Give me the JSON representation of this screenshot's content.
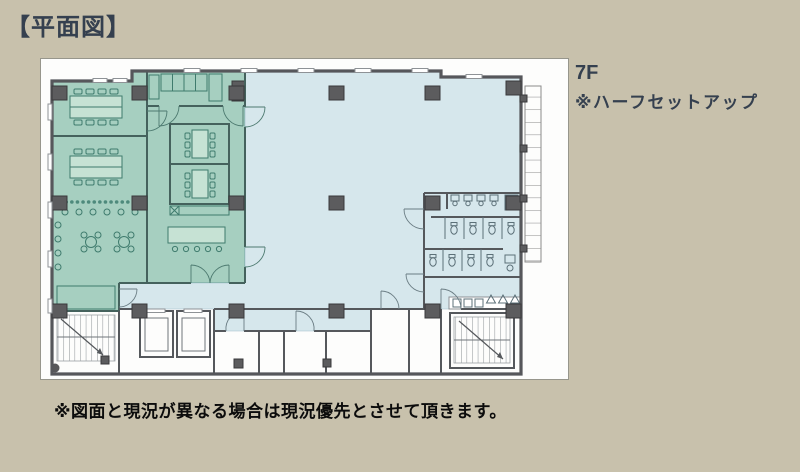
{
  "title": "【平面図】",
  "plan_labels": {
    "floor": "7F",
    "setup_note": "※ハーフセットアップ"
  },
  "footer_note": "※図面と現況が異なる場合は現況優先とさせて頂きます。",
  "colors": {
    "background_tan": "#c8c1ac",
    "heading_navy": "#35404f",
    "note_black": "#0c0c0c",
    "halfsetup_green": "#a6cfc0",
    "open_area_blue": "#d6e7ec",
    "wall_gray": "#56575b",
    "column_gray": "#5c5c5e"
  }
}
